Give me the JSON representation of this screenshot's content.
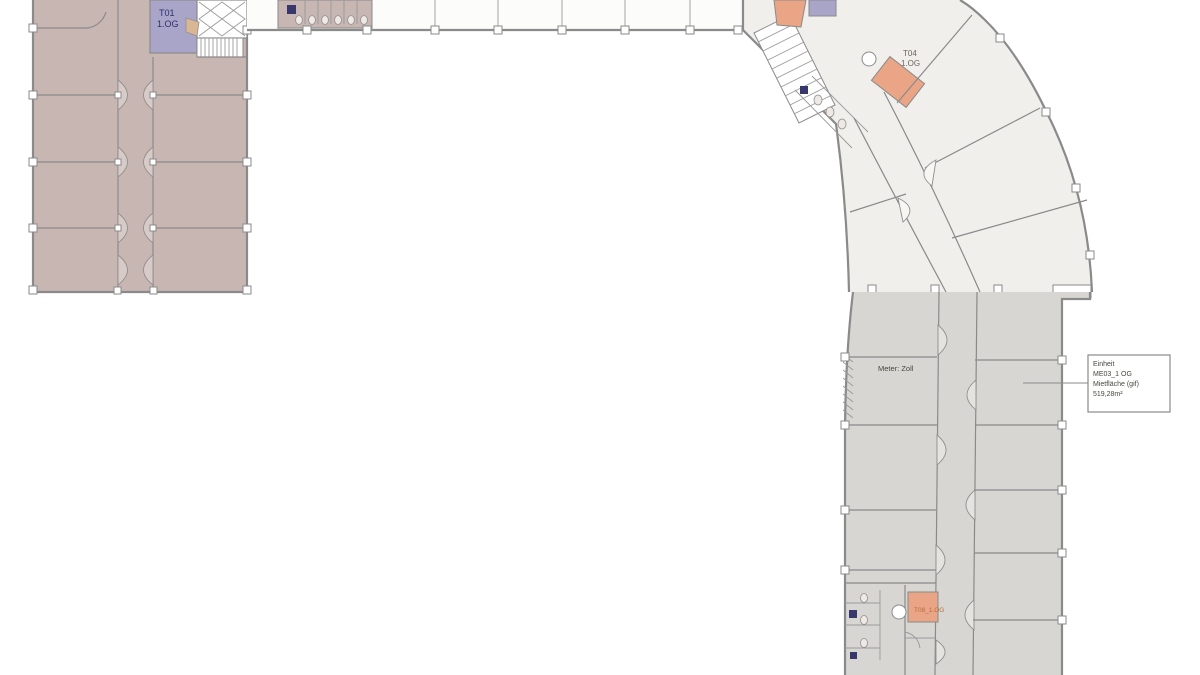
{
  "labels": {
    "t01": {
      "line1": "T01",
      "line2": "1.OG"
    },
    "t04": {
      "line1": "T04",
      "line2": "1.OG"
    },
    "t08": "T08_1.OG",
    "scale_note": "Meter: Zoll"
  },
  "annotation_box": {
    "line1": "Einheit",
    "line2": "ME03_1 OG",
    "line3": "Mietfläche (gif)",
    "line4": "519,28m²"
  },
  "colors": {
    "left_wing_fill": "#c7b6b2",
    "upper_curve_fill": "#f0efec",
    "lower_wing_fill": "#d8d6d2",
    "stair_core_purple": "#a8a5c9",
    "elevator_orange": "#e9a585",
    "wall_stroke": "#8a8a8a",
    "t01_text": "#2f2f6b",
    "t04_text": "#6f655c",
    "t08_text": "#b86a3c",
    "annotation_text": "#4a463f"
  }
}
